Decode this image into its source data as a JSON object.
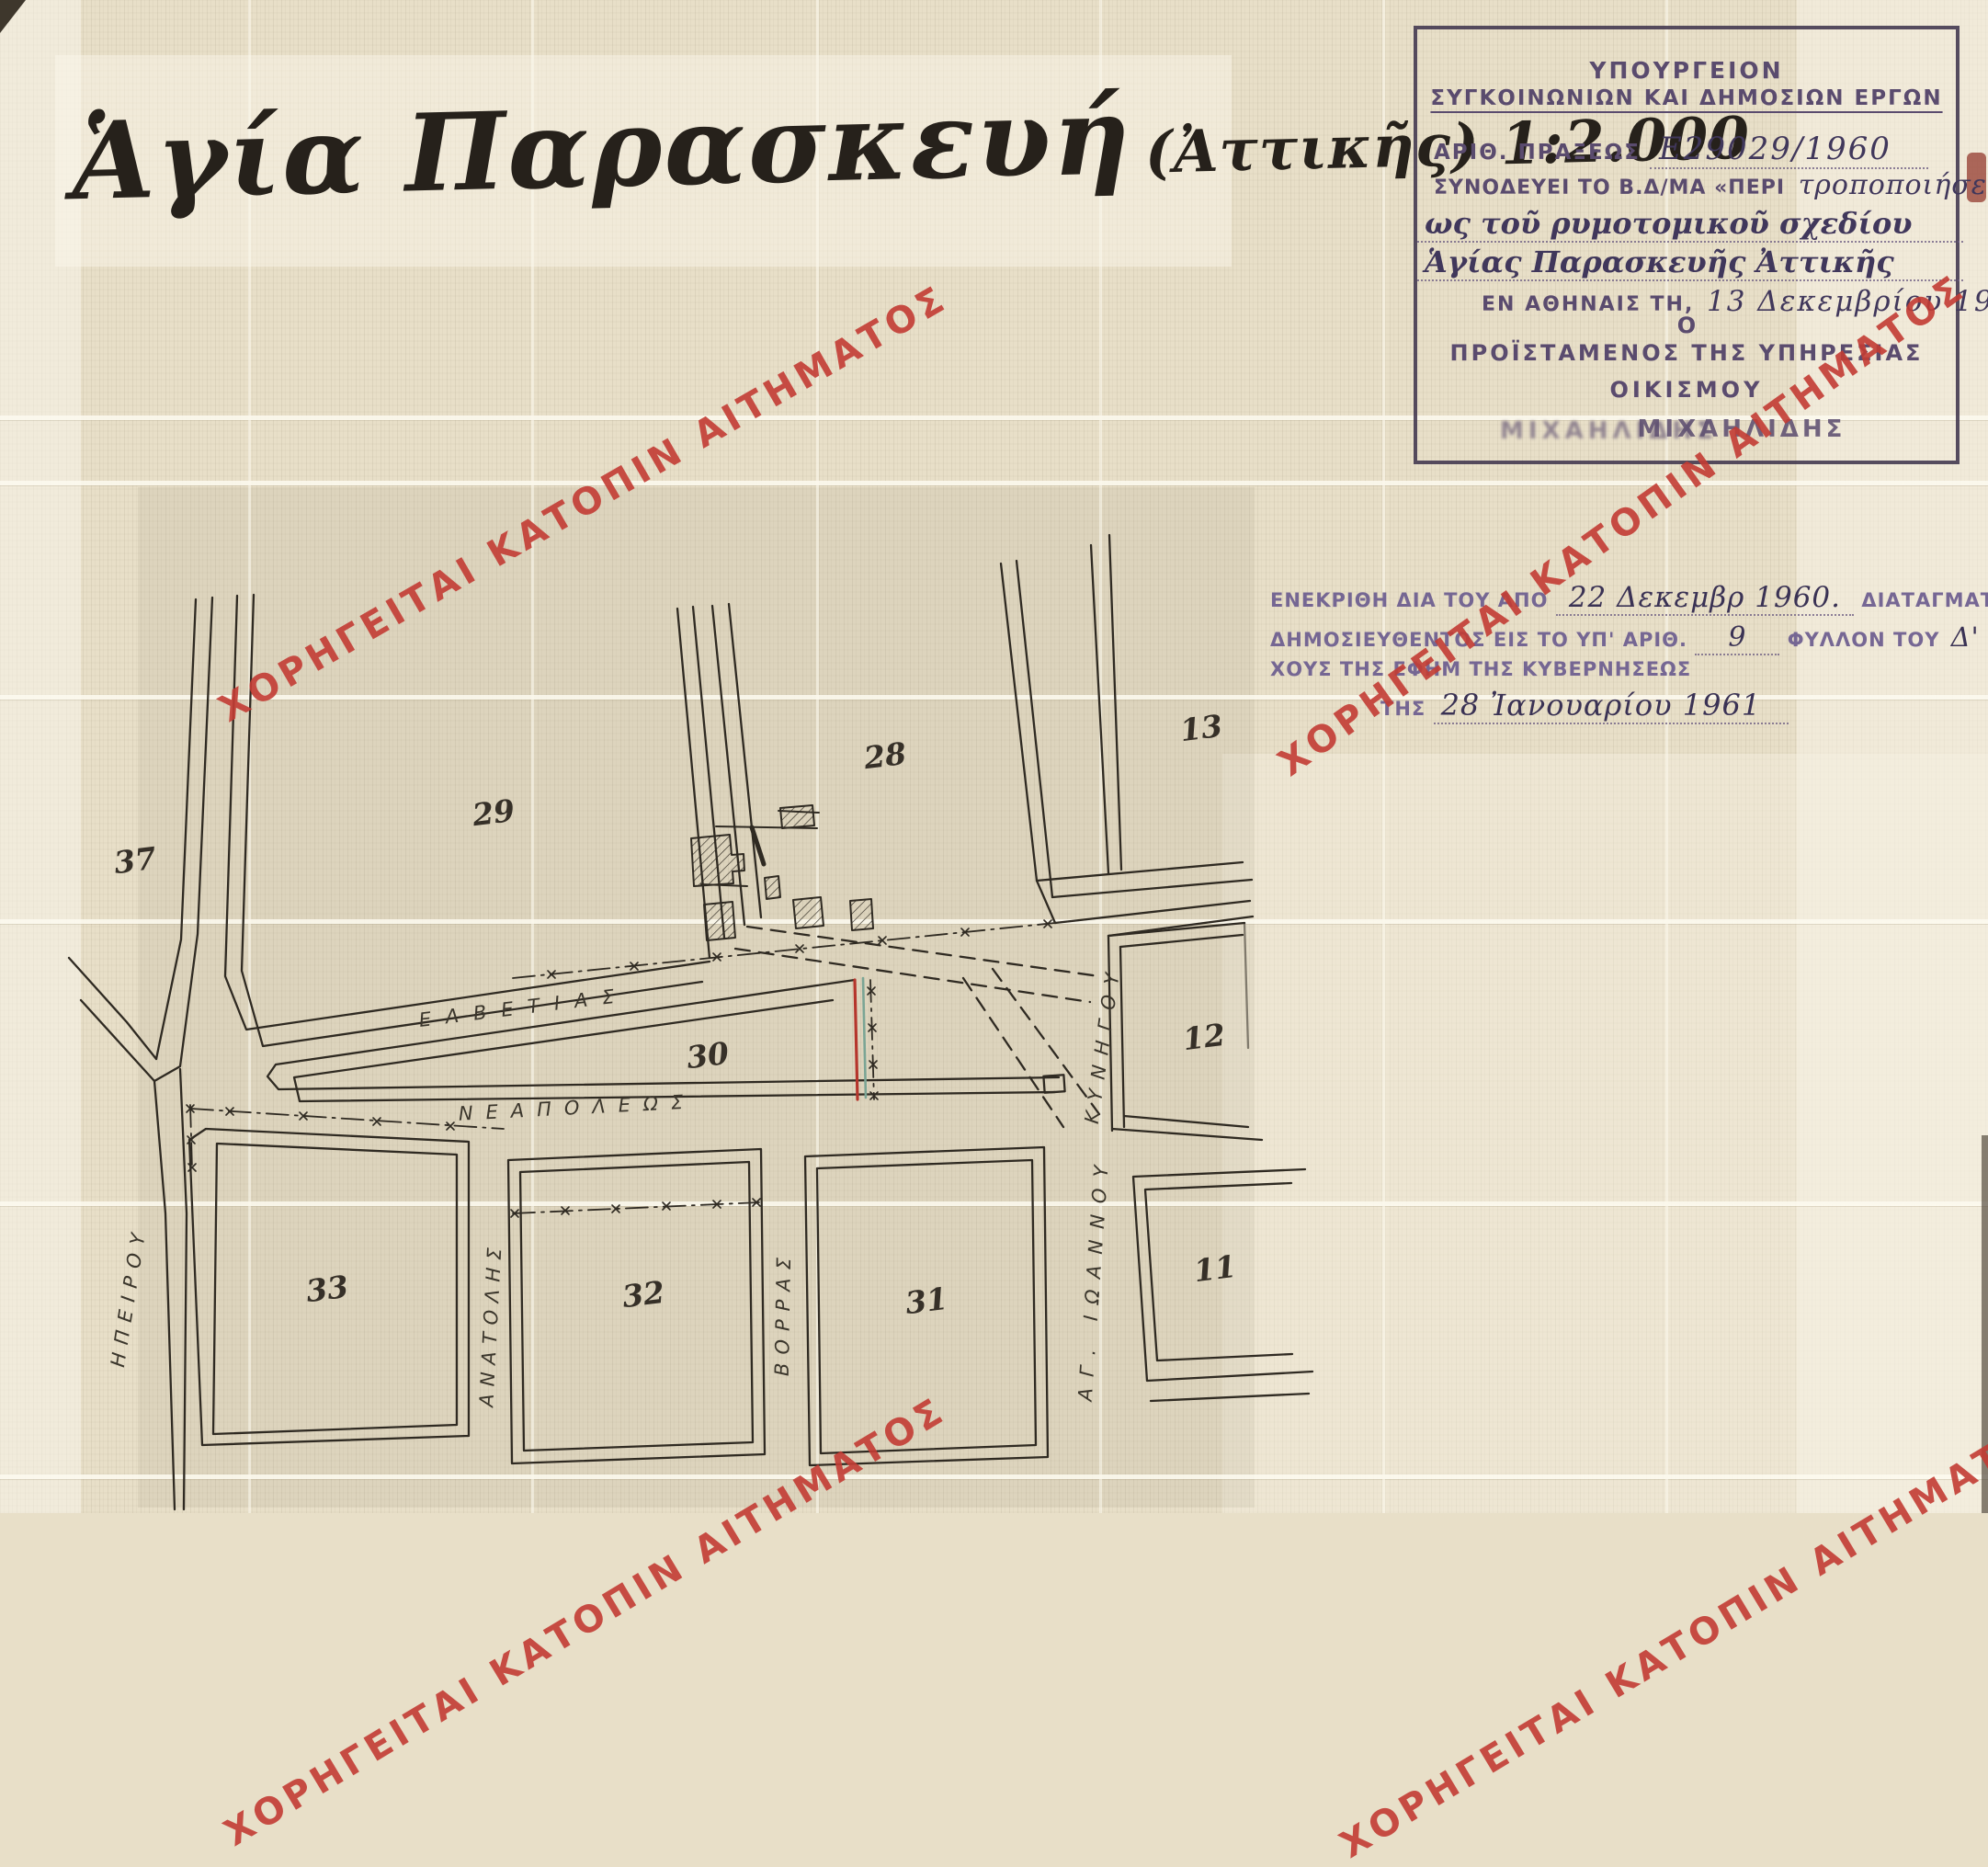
{
  "title": {
    "main": "Ἁγία Παρασκευή",
    "suffix": "(Ἀττικῆς) 1:2.000"
  },
  "watermark": {
    "text": "ΧΟΡΗΓΕΙΤΑΙ ΚΑΤΟΠΙΝ ΑΙΤΗΜΑΤΟΣ",
    "color": "#c33c34"
  },
  "stamp": {
    "ministry_line1": "ΥΠΟΥΡΓΕΙΟΝ",
    "ministry_line2": "ΣΥΓΚΟΙΝΩΝΙΩΝ ΚΑΙ ΔΗΜΟΣΙΩΝ ΕΡΓΩΝ",
    "act_label": "ΑΡΙΘ. ΠΡΑΞΕΩΣ",
    "act_value": "Ε29029/1960",
    "accompanies_label": "ΣΥΝΟΔΕΥΕΙ ΤΟ Β.Δ/ΜΑ «ΠΕΡΙ",
    "accompanies_hw1": "τροποποιήσε",
    "accompanies_hw2": "ως τοῦ ρυμοτομικοῦ σχεδίου",
    "accompanies_hw3": "Ἁγίας Παρασκευῆς Ἀττικῆς",
    "place_date_label": "ΕΝ ΑΘΗΝΑΙΣ ΤΗ,",
    "place_date_value": "13 Δεκεμβρίου 1960",
    "article": "Ο",
    "head_title_line1": "ΠΡΟΪΣΤΑΜΕΝΟΣ ΤΗΣ ΥΠΗΡΕΣΙΑΣ",
    "head_title_line2": "ΟΙΚΙΣΜΟΥ",
    "signature": "ΜΙΧΑΗΛΙΔΗΣ"
  },
  "approval": {
    "line1_a": "ΕΝΕΚΡΙΘΗ ΔΙΑ ΤΟΥ ΑΠΟ",
    "line1_hw": "22 Δεκεμβρ 1960.",
    "line1_b": "ΔΙΑΤΑΓΜΑΤΟΣ",
    "line2_a": "ΔΗΜΟΣΙΕΥΘΕΝΤΟΣ ΕΙΣ ΤΟ ΥΠ' ΑΡΙΘ.",
    "line2_hw1": "9",
    "line2_b": "ΦΥΛΛΟΝ ΤΟΥ",
    "line2_hw2": "Δ'",
    "line2_c": "ΤΕΥ-",
    "line3": "ΧΟΥΣ ΤΗΣ ΕΦΗΜ ΤΗΣ ΚΥΒΕΡΝΗΣΕΩΣ",
    "line4_a": "ΤΗΣ",
    "line4_hw": "28 Ἰανουαρίου 1961"
  },
  "map": {
    "ink_color": "#2f2a22",
    "red_line_color": "#b5352c",
    "teal_line_color": "#7ba595",
    "blocks": [
      {
        "label": "37"
      },
      {
        "label": "29"
      },
      {
        "label": "28"
      },
      {
        "label": "13"
      },
      {
        "label": "30"
      },
      {
        "label": "12"
      },
      {
        "label": "33"
      },
      {
        "label": "32"
      },
      {
        "label": "31"
      },
      {
        "label": "11"
      }
    ],
    "streets": [
      {
        "label": "ΕΛΒΕΤΙΑΣ"
      },
      {
        "label": "ΝΕΑΠΟΛΕΩΣ"
      },
      {
        "label": "ΑΝΑΤΟΛΗΣ"
      },
      {
        "label": "ΒΟΡΡΑΣ"
      },
      {
        "label": "ΗΠΕΙΡΟΥ"
      },
      {
        "label": "ΑΓ. ΙΩΑΝΝΟΥ"
      },
      {
        "label": "ΚΥΝΗΓΟΥ"
      }
    ]
  }
}
